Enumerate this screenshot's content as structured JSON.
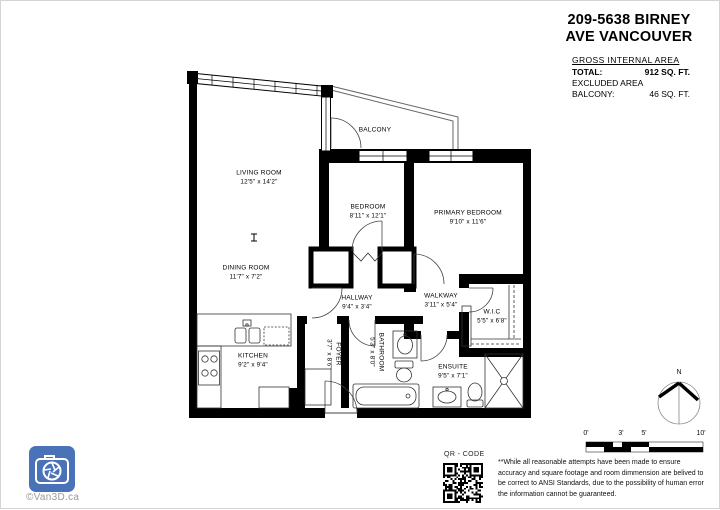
{
  "header": {
    "title_line1": "209-5638 BIRNEY",
    "title_line2": "AVE VANCOUVER"
  },
  "area_summary": {
    "heading": "GROSS INTERNAL AREA",
    "total_label": "TOTAL:",
    "total_value": "912 SQ. FT.",
    "excluded_heading": "EXCLUDED AREA",
    "balcony_label": "BALCONY:",
    "balcony_value": "46 SQ. FT."
  },
  "floorplan": {
    "rooms": [
      {
        "name": "LIVING ROOM",
        "dims": "12'5\" x 14'2\""
      },
      {
        "name": "DINING ROOM",
        "dims": "11'7\" x 7'2\""
      },
      {
        "name": "KITCHEN",
        "dims": "9'2\" x 9'4\""
      },
      {
        "name": "BALCONY",
        "dims": ""
      },
      {
        "name": "BEDROOM",
        "dims": "8'11\" x 12'1\""
      },
      {
        "name": "PRIMARY BEDROOM",
        "dims": "9'10\" x 11'6\""
      },
      {
        "name": "HALLWAY",
        "dims": "9'4\" x 3'4\""
      },
      {
        "name": "WALKWAY",
        "dims": "3'11\" x 5'4\""
      },
      {
        "name": "W.I.C",
        "dims": "5'5\" x 6'8\""
      },
      {
        "name": "ENSUITE",
        "dims": "9'5\" x 7'1\""
      },
      {
        "name": "FOYER",
        "dims": "3'7\" x 8'6\""
      },
      {
        "name": "BATHROOM",
        "dims": "5'3\" x 8'0\""
      }
    ]
  },
  "scale_bar": {
    "labels": [
      "0'",
      "3'",
      "5'",
      "10'"
    ]
  },
  "compass": {
    "north_label": "N"
  },
  "footer": {
    "qr_label": "QR - CODE",
    "disclaimer": "**While all reasonable attempts have been made to ensure accuracy and square footage and room dimmension are belived to be correct to ANSI Standards, due to the possibility of human error the information cannot be guaranteed.",
    "watermark": "©Van3D.ca"
  },
  "colors": {
    "wall": "#000000",
    "logo_blue": "#4a72b8",
    "thin_line": "#333333"
  }
}
